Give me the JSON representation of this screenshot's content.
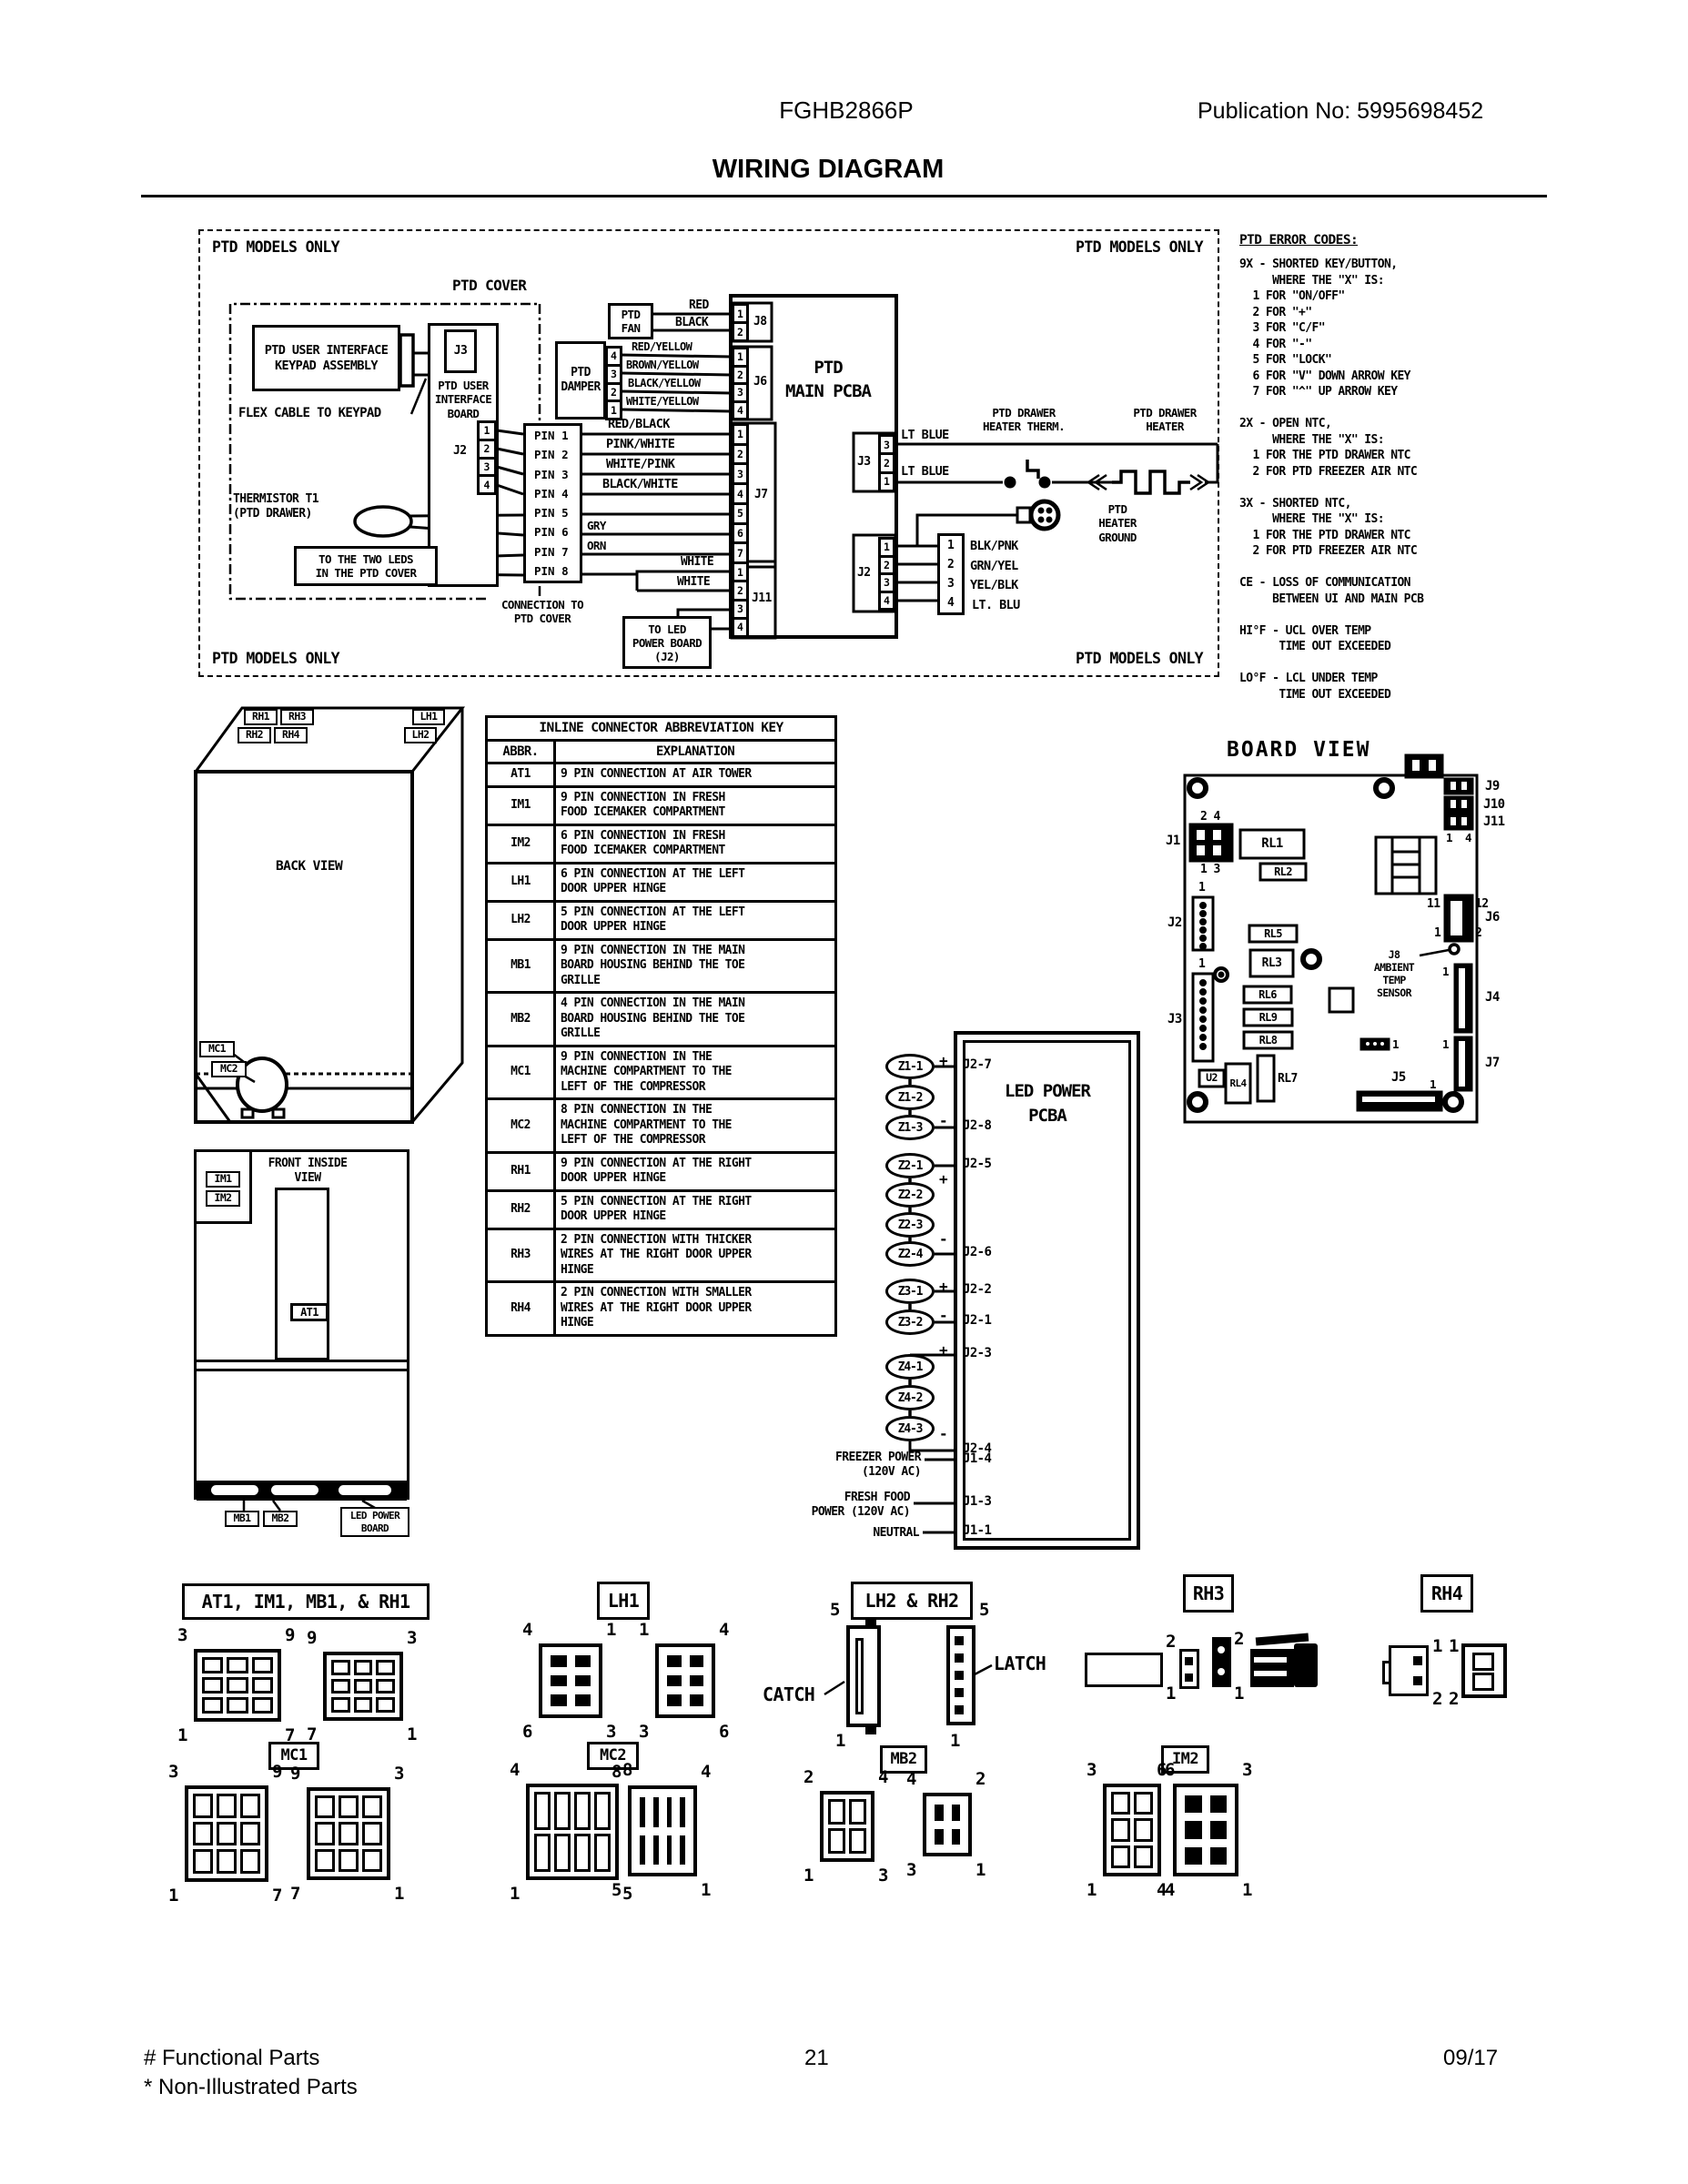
{
  "header": {
    "model": "FGHB2866P",
    "publication": "Publication No:  5995698452",
    "title": "WIRING DIAGRAM"
  },
  "schematic": {
    "corner_label": "PTD MODELS ONLY",
    "ptd_cover": "PTD COVER",
    "keypad_assembly": "PTD USER INTERFACE\nKEYPAD ASSEMBLY",
    "flex_cable": "FLEX CABLE TO KEYPAD",
    "j3_ui": "J3",
    "ui_board": "PTD USER\nINTERFACE\nBOARD",
    "j2_ui": "J2",
    "ui_j2_pins": [
      "1",
      "2",
      "3",
      "4"
    ],
    "pin_rows": [
      "PIN 1",
      "PIN 2",
      "PIN 3",
      "PIN 4",
      "PIN 5",
      "PIN 6",
      "PIN 7",
      "PIN 8"
    ],
    "pin_wire_labels": [
      "RED/BLACK",
      "PINK/WHITE",
      "WHITE/PINK",
      "BLACK/WHITE"
    ],
    "gry": "GRY",
    "orn": "ORN",
    "white_top": "WHITE",
    "white_bottom": "WHITE",
    "thermistor": "THERMISTOR T1\n(PTD DRAWER)",
    "to_leds": "TO THE TWO LEDS\nIN THE PTD COVER",
    "connection_to_cover": "CONNECTION TO\nPTD COVER",
    "to_led_power": "TO LED\nPOWER BOARD\n(J2)",
    "ptd_fan": "PTD\nFAN",
    "fan_wire_red": "RED",
    "fan_wire_black": "BLACK",
    "ptd_damper": "PTD\nDAMPER",
    "damper_pins": [
      "4",
      "3",
      "2",
      "1"
    ],
    "damper_wires": [
      "RED/YELLOW",
      "BROWN/YELLOW",
      "BLACK/YELLOW",
      "WHITE/YELLOW"
    ],
    "main_pcba": "PTD\nMAIN PCBA",
    "j8": "J8",
    "j8_pins": [
      "1",
      "2"
    ],
    "j6": "J6",
    "j6_pins": [
      "1",
      "2",
      "3",
      "4"
    ],
    "j7": "J7",
    "j7_pins": [
      "1",
      "2",
      "3",
      "4",
      "5",
      "6",
      "7"
    ],
    "j11": "J11",
    "j11_pins": [
      "1",
      "2",
      "3",
      "4"
    ],
    "j3_right": "J3",
    "j3_right_pins": [
      "3",
      "2",
      "1"
    ],
    "j2_right": "J2",
    "j2_right_pins": [
      "1",
      "2",
      "3",
      "4"
    ],
    "lt_blue_top": "LT BLUE",
    "lt_blue_bottom": "LT BLUE",
    "heater_therm": "PTD DRAWER\nHEATER THERM.",
    "heater": "PTD DRAWER\nHEATER",
    "heater_ground": "PTD\nHEATER\nGROUND",
    "inline4_pins": [
      "1",
      "2",
      "3",
      "4"
    ],
    "inline4_wires": [
      "BLK/PNK",
      "GRN/YEL",
      "YEL/BLK",
      "LT. BLU"
    ]
  },
  "error_codes": {
    "title": "PTD ERROR CODES:",
    "lines": [
      "9X - SHORTED KEY/BUTTON,",
      "     WHERE THE \"X\" IS:",
      "  1 FOR \"ON/OFF\"",
      "  2 FOR \"+\"",
      "  3 FOR \"C/F\"",
      "  4 FOR \"-\"",
      "  5 FOR \"LOCK\"",
      "  6 FOR \"V\" DOWN ARROW KEY",
      "  7 FOR \"^\" UP ARROW KEY",
      "",
      "2X - OPEN NTC,",
      "     WHERE THE \"X\" IS:",
      "  1 FOR THE PTD DRAWER NTC",
      "  2 FOR PTD FREEZER AIR NTC",
      "",
      "3X - SHORTED NTC,",
      "     WHERE THE \"X\" IS:",
      "  1 FOR THE PTD DRAWER NTC",
      "  2 FOR PTD FREEZER AIR NTC",
      "",
      "CE - LOSS OF COMMUNICATION",
      "     BETWEEN UI AND MAIN PCB",
      "",
      "HI°F - UCL OVER TEMP",
      "      TIME OUT EXCEEDED",
      "",
      "LO°F - LCL UNDER TEMP",
      "      TIME OUT EXCEEDED"
    ]
  },
  "back_view": {
    "title": "BACK VIEW",
    "rh1": "RH1",
    "rh3": "RH3",
    "rh2": "RH2",
    "rh4": "RH4",
    "lh1": "LH1",
    "lh2": "LH2",
    "mc1": "MC1",
    "mc2": "MC2"
  },
  "front_view": {
    "title": "FRONT INSIDE\nVIEW",
    "im1": "IM1",
    "im2": "IM2",
    "at1": "AT1",
    "mb1": "MB1",
    "mb2": "MB2",
    "led_power_board": "LED POWER\nBOARD"
  },
  "abbr_table": {
    "title": "INLINE CONNECTOR ABBREVIATION KEY",
    "col_abbr": "ABBR.",
    "col_expl": "EXPLANATION",
    "rows": [
      {
        "abbr": "AT1",
        "text": "9 PIN CONNECTION AT AIR TOWER"
      },
      {
        "abbr": "IM1",
        "text": "9 PIN CONNECTION IN FRESH\nFOOD ICEMAKER COMPARTMENT"
      },
      {
        "abbr": "IM2",
        "text": "6 PIN CONNECTION IN FRESH\nFOOD ICEMAKER COMPARTMENT"
      },
      {
        "abbr": "LH1",
        "text": "6 PIN CONNECTION AT THE LEFT\nDOOR UPPER HINGE"
      },
      {
        "abbr": "LH2",
        "text": "5 PIN CONNECTION AT THE LEFT\nDOOR UPPER HINGE"
      },
      {
        "abbr": "MB1",
        "text": "9 PIN CONNECTION IN THE MAIN\nBOARD HOUSING BEHIND THE TOE\nGRILLE"
      },
      {
        "abbr": "MB2",
        "text": "4 PIN CONNECTION IN THE MAIN\nBOARD HOUSING BEHIND THE TOE\nGRILLE"
      },
      {
        "abbr": "MC1",
        "text": "9 PIN CONNECTION IN THE\nMACHINE COMPARTMENT TO THE\nLEFT OF THE COMPRESSOR"
      },
      {
        "abbr": "MC2",
        "text": "8 PIN CONNECTION IN THE\nMACHINE COMPARTMENT TO THE\nLEFT OF THE COMPRESSOR"
      },
      {
        "abbr": "RH1",
        "text": "9 PIN CONNECTION AT THE RIGHT\nDOOR UPPER HINGE"
      },
      {
        "abbr": "RH2",
        "text": "5 PIN CONNECTION AT THE RIGHT\nDOOR UPPER HINGE"
      },
      {
        "abbr": "RH3",
        "text": "2 PIN CONNECTION WITH THICKER\nWIRES AT THE RIGHT DOOR UPPER\nHINGE"
      },
      {
        "abbr": "RH4",
        "text": "2 PIN CONNECTION WITH SMALLER\nWIRES AT THE RIGHT DOOR UPPER\nHINGE"
      }
    ]
  },
  "led_pcba": {
    "title": "LED POWER\nPCBA",
    "ovals": [
      "Z1-1",
      "Z1-2",
      "Z1-3",
      "Z2-1",
      "Z2-2",
      "Z2-3",
      "Z2-4",
      "Z3-1",
      "Z3-2",
      "Z4-1",
      "Z4-2",
      "Z4-3"
    ],
    "pin_labels": [
      "J2-7",
      "J2-8",
      "J2-5",
      "J2-6",
      "J2-2",
      "J2-1",
      "J2-3",
      "J2-4",
      "J1-4",
      "J1-3",
      "J1-1"
    ],
    "power_freezer": "FREEZER POWER\n(120V AC)",
    "power_fresh": "FRESH FOOD\nPOWER (120V AC)",
    "power_neutral": "NEUTRAL"
  },
  "board_view": {
    "title": "BOARD VIEW",
    "j1": "J1",
    "j2": "J2",
    "j3": "J3",
    "j4": "J4",
    "j5": "J5",
    "j6": "J6",
    "j7": "J7",
    "j9": "J9",
    "j10": "J10",
    "j11": "J11",
    "u2": "U2",
    "rl1": "RL1",
    "rl2": "RL2",
    "rl3": "RL3",
    "rl4": "RL4",
    "rl5": "RL5",
    "rl6": "RL6",
    "rl7": "RL7",
    "rl8": "RL8",
    "rl9": "RL9",
    "ambient": "J8\nAMBIENT\nTEMP\nSENSOR",
    "j1_top": "2  4",
    "j1_bottom": "1  3",
    "one": "1",
    "four": "4",
    "two": "2",
    "three": "3",
    "j6_11": "11",
    "j6_12": "12",
    "j6_1": "1",
    "j6_2": "2"
  },
  "pinouts": {
    "group1": {
      "label": "AT1, IM1, MB1, & RH1",
      "left_corners": [
        "3",
        "9",
        "1",
        "7"
      ],
      "right_corners": [
        "9",
        "3",
        "7",
        "1"
      ]
    },
    "lh1": {
      "label": "LH1",
      "left_corners": [
        "4",
        "1",
        "6",
        "3"
      ],
      "right_corners": [
        "1",
        "4",
        "3",
        "6"
      ]
    },
    "lh2rh2": {
      "label": "LH2 & RH2",
      "catch": "CATCH",
      "latch": "LATCH",
      "left_top": "5",
      "left_bottom": "1",
      "right_top": "5",
      "right_bottom": "1"
    },
    "rh3": {
      "label": "RH3",
      "a_top": "2",
      "a_bottom": "1",
      "b_top": "2",
      "b_bottom": "1"
    },
    "rh4": {
      "label": "RH4",
      "a_top": "1",
      "a_bottom": "2",
      "b_top": "1",
      "b_bottom": "2"
    },
    "mc1": {
      "label": "MC1",
      "left_corners": [
        "3",
        "9",
        "1",
        "7"
      ],
      "right_corners": [
        "9",
        "3",
        "7",
        "1"
      ]
    },
    "mc2": {
      "label": "MC2",
      "left_corners": [
        "4",
        "8",
        "1",
        "5"
      ],
      "right_corners": [
        "8",
        "4",
        "5",
        "1"
      ]
    },
    "mb2": {
      "label": "MB2",
      "left_corners": [
        "2",
        "4",
        "1",
        "3"
      ],
      "right_corners": [
        "4",
        "2",
        "3",
        "1"
      ]
    },
    "im2": {
      "label": "IM2",
      "left_corners": [
        "3",
        "6",
        "1",
        "4"
      ],
      "right_corners": [
        "6",
        "3",
        "4",
        "1"
      ]
    }
  },
  "footer": {
    "note1": "# Functional Parts",
    "note2": "* Non-Illustrated Parts",
    "page": "21",
    "date": "09/17"
  }
}
